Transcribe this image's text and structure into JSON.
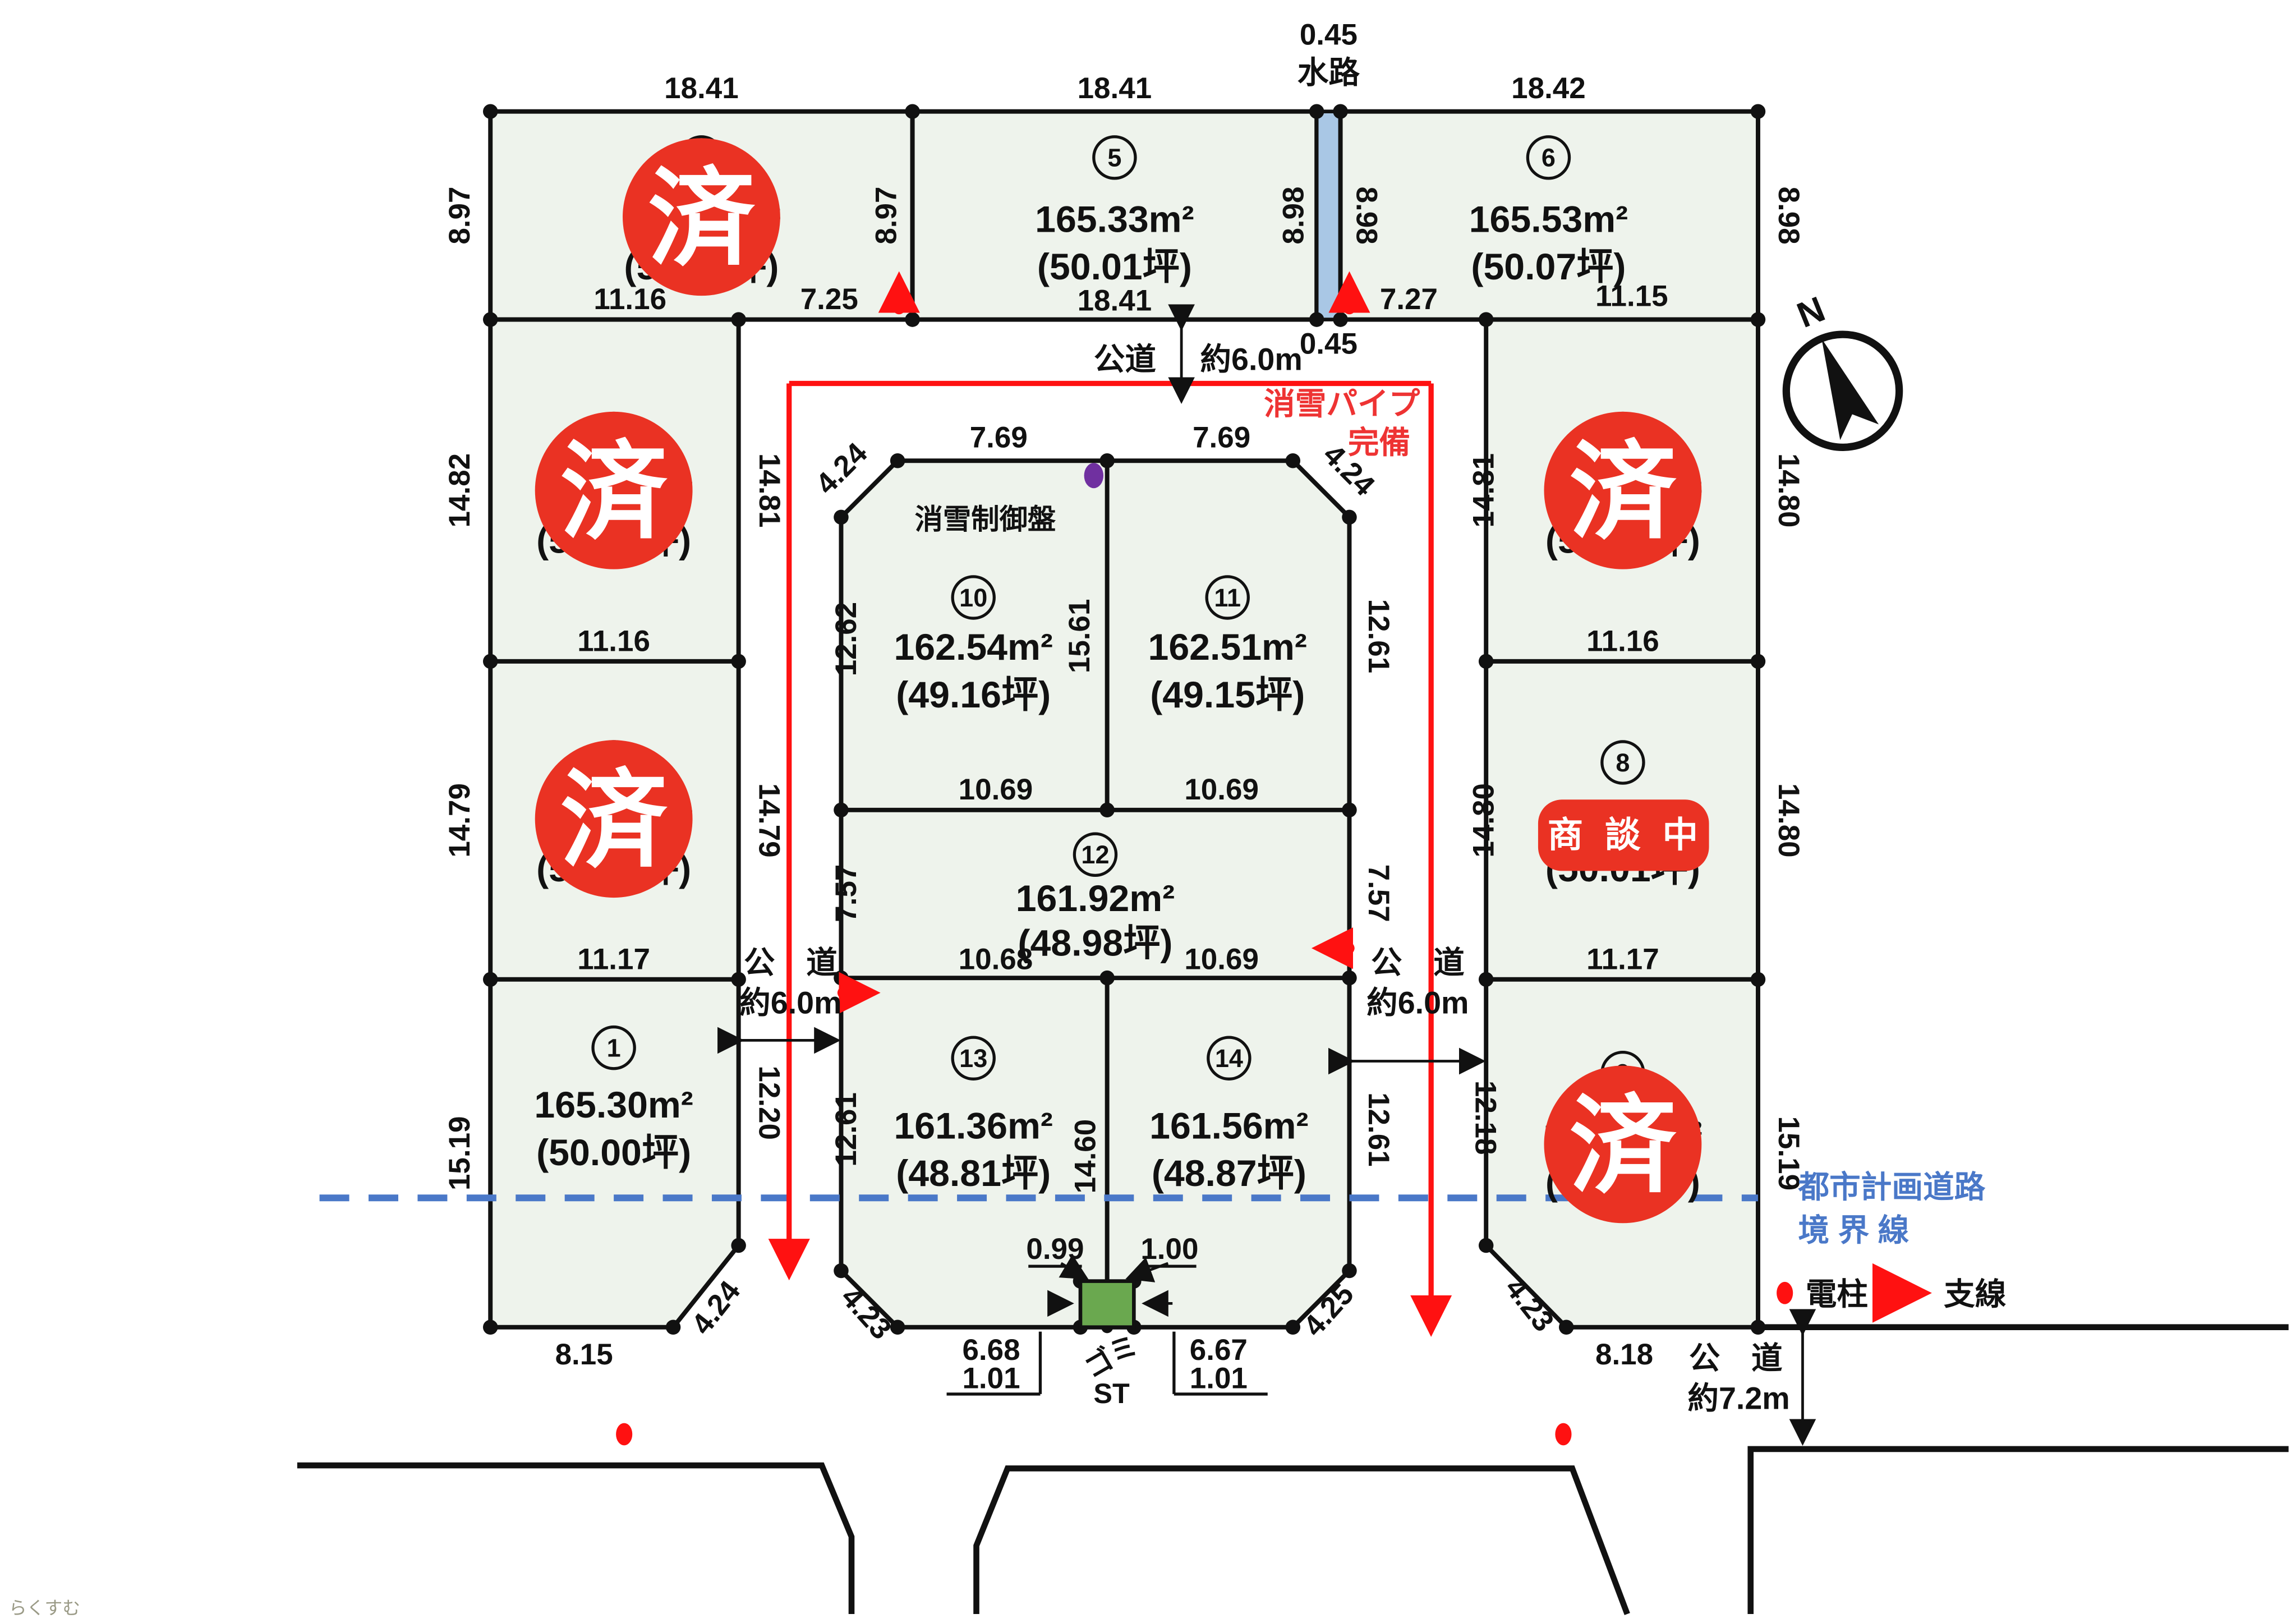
{
  "drawing": {
    "north_label": "N",
    "watermark": "らくすむ",
    "status": {
      "sold": "済",
      "negotiating": "商 談 中"
    },
    "legend": {
      "pole": "電柱",
      "wire": "支線"
    },
    "boundary": {
      "line1": "都市計画道路",
      "line2": "境 界 線"
    },
    "snow": {
      "pipe_line1": "消雪パイプ",
      "pipe_line2": "完備",
      "panel": "消雪制御盤"
    },
    "waterway": {
      "name": "水路",
      "width_top": "0.45",
      "width_bottom": "0.45"
    },
    "trash": {
      "line1": "ゴミ",
      "line2": "ST"
    },
    "roads": {
      "top": {
        "name": "公道",
        "width": "約6.0m"
      },
      "left": {
        "name": "公　道",
        "width": "約6.0m"
      },
      "right": {
        "name": "公　道",
        "width": "約6.0m"
      },
      "bottom": {
        "name": "公　道",
        "width": "約7.2m"
      }
    }
  },
  "lots": {
    "1": {
      "no": "1",
      "area": "165.30m²",
      "tsubo": "(50.00坪)",
      "status": "available"
    },
    "2": {
      "no": "2",
      "area": "165.31m²",
      "tsubo": "(50.00坪)",
      "status": "sold"
    },
    "3": {
      "no": "3",
      "area": "165.48m²",
      "tsubo": "(50.06坪)",
      "status": "sold"
    },
    "4": {
      "no": "4",
      "area": "165.30m²",
      "tsubo": "(50.00坪)",
      "status": "sold"
    },
    "5": {
      "no": "5",
      "area": "165.33m²",
      "tsubo": "(50.01坪)",
      "status": "available"
    },
    "6": {
      "no": "6",
      "area": "165.53m²",
      "tsubo": "(50.07坪)",
      "status": "available"
    },
    "7": {
      "no": "7",
      "area": "165.30m²",
      "tsubo": "(50.00坪)",
      "status": "sold"
    },
    "8": {
      "no": "8",
      "area": "165.34m²",
      "tsubo": "(50.01坪)",
      "status": "negotiating"
    },
    "9": {
      "no": "9",
      "area": "165.30m²",
      "tsubo": "(50.00坪)",
      "status": "sold"
    },
    "10": {
      "no": "10",
      "area": "162.54m²",
      "tsubo": "(49.16坪)",
      "status": "available"
    },
    "11": {
      "no": "11",
      "area": "162.51m²",
      "tsubo": "(49.15坪)",
      "status": "available"
    },
    "12": {
      "no": "12",
      "area": "161.92m²",
      "tsubo": "(48.98坪)",
      "status": "available"
    },
    "13": {
      "no": "13",
      "area": "161.36m²",
      "tsubo": "(48.81坪)",
      "status": "available"
    },
    "14": {
      "no": "14",
      "area": "161.56m²",
      "tsubo": "(48.87坪)",
      "status": "available"
    }
  },
  "dims": {
    "lot4_top": "18.41",
    "lot5_top": "18.41",
    "lot6_top": "18.42",
    "lot4_left": "8.97",
    "div45": "8.97",
    "ww_left": "8.98",
    "ww_right": "8.98",
    "lot6_right": "8.98",
    "lot4_bot_a": "11.16",
    "lot4_bot_b": "7.25",
    "lot5_bot": "18.41",
    "lot6_bot_a": "7.27",
    "lot6_bot_b": "11.15",
    "lot3_left": "14.82",
    "lot3_right": "14.81",
    "lot3_bot": "11.16",
    "lot2_left": "14.79",
    "lot2_right": "14.79",
    "lot2_bot": "11.17",
    "lot1_left": "15.19",
    "lot1_right": "12.20",
    "lot1_bot": "8.15",
    "lot1_cham": "4.24",
    "mb_cham_tl": "4.24",
    "lot10_top": "7.69",
    "lot11_top": "7.69",
    "mb_cham_tr": "4.24",
    "lot10_left": "12.62",
    "div_10_11": "15.61",
    "lot11_right": "12.61",
    "lot10_bot": "10.69",
    "lot11_bot": "10.69",
    "lot12_left": "7.57",
    "lot12_right": "7.57",
    "lot12_bot_a": "10.68",
    "lot12_bot_b": "10.69",
    "lot13_left": "12.61",
    "div_13_14": "14.60",
    "lot14_right": "12.61",
    "mb_cham_bl": "4.23",
    "mb_cham_br": "4.25",
    "trash_top_l": "0.99",
    "trash_top_r": "1.00",
    "bot_l1": "6.68",
    "bot_l2": "1.01",
    "bot_r1": "6.67",
    "bot_r2": "1.01",
    "lot7_left": "14.81",
    "lot7_right": "14.80",
    "lot7_bot": "11.16",
    "lot8_left": "14.80",
    "lot8_right": "14.80",
    "lot8_bot": "11.17",
    "lot9_left": "12.18",
    "lot9_right": "15.19",
    "lot9_bot": "8.18",
    "lot9_cham": "4.23"
  },
  "colors": {
    "lot_fill": "#eef3ec",
    "sold_red": "#ea3223",
    "waterway_blue": "#a9c7e5",
    "boundary_blue": "#4a78c8",
    "pipe_red": "#ff1111",
    "panel_purple": "#7030a0",
    "trash_green": "#6aa84f"
  }
}
